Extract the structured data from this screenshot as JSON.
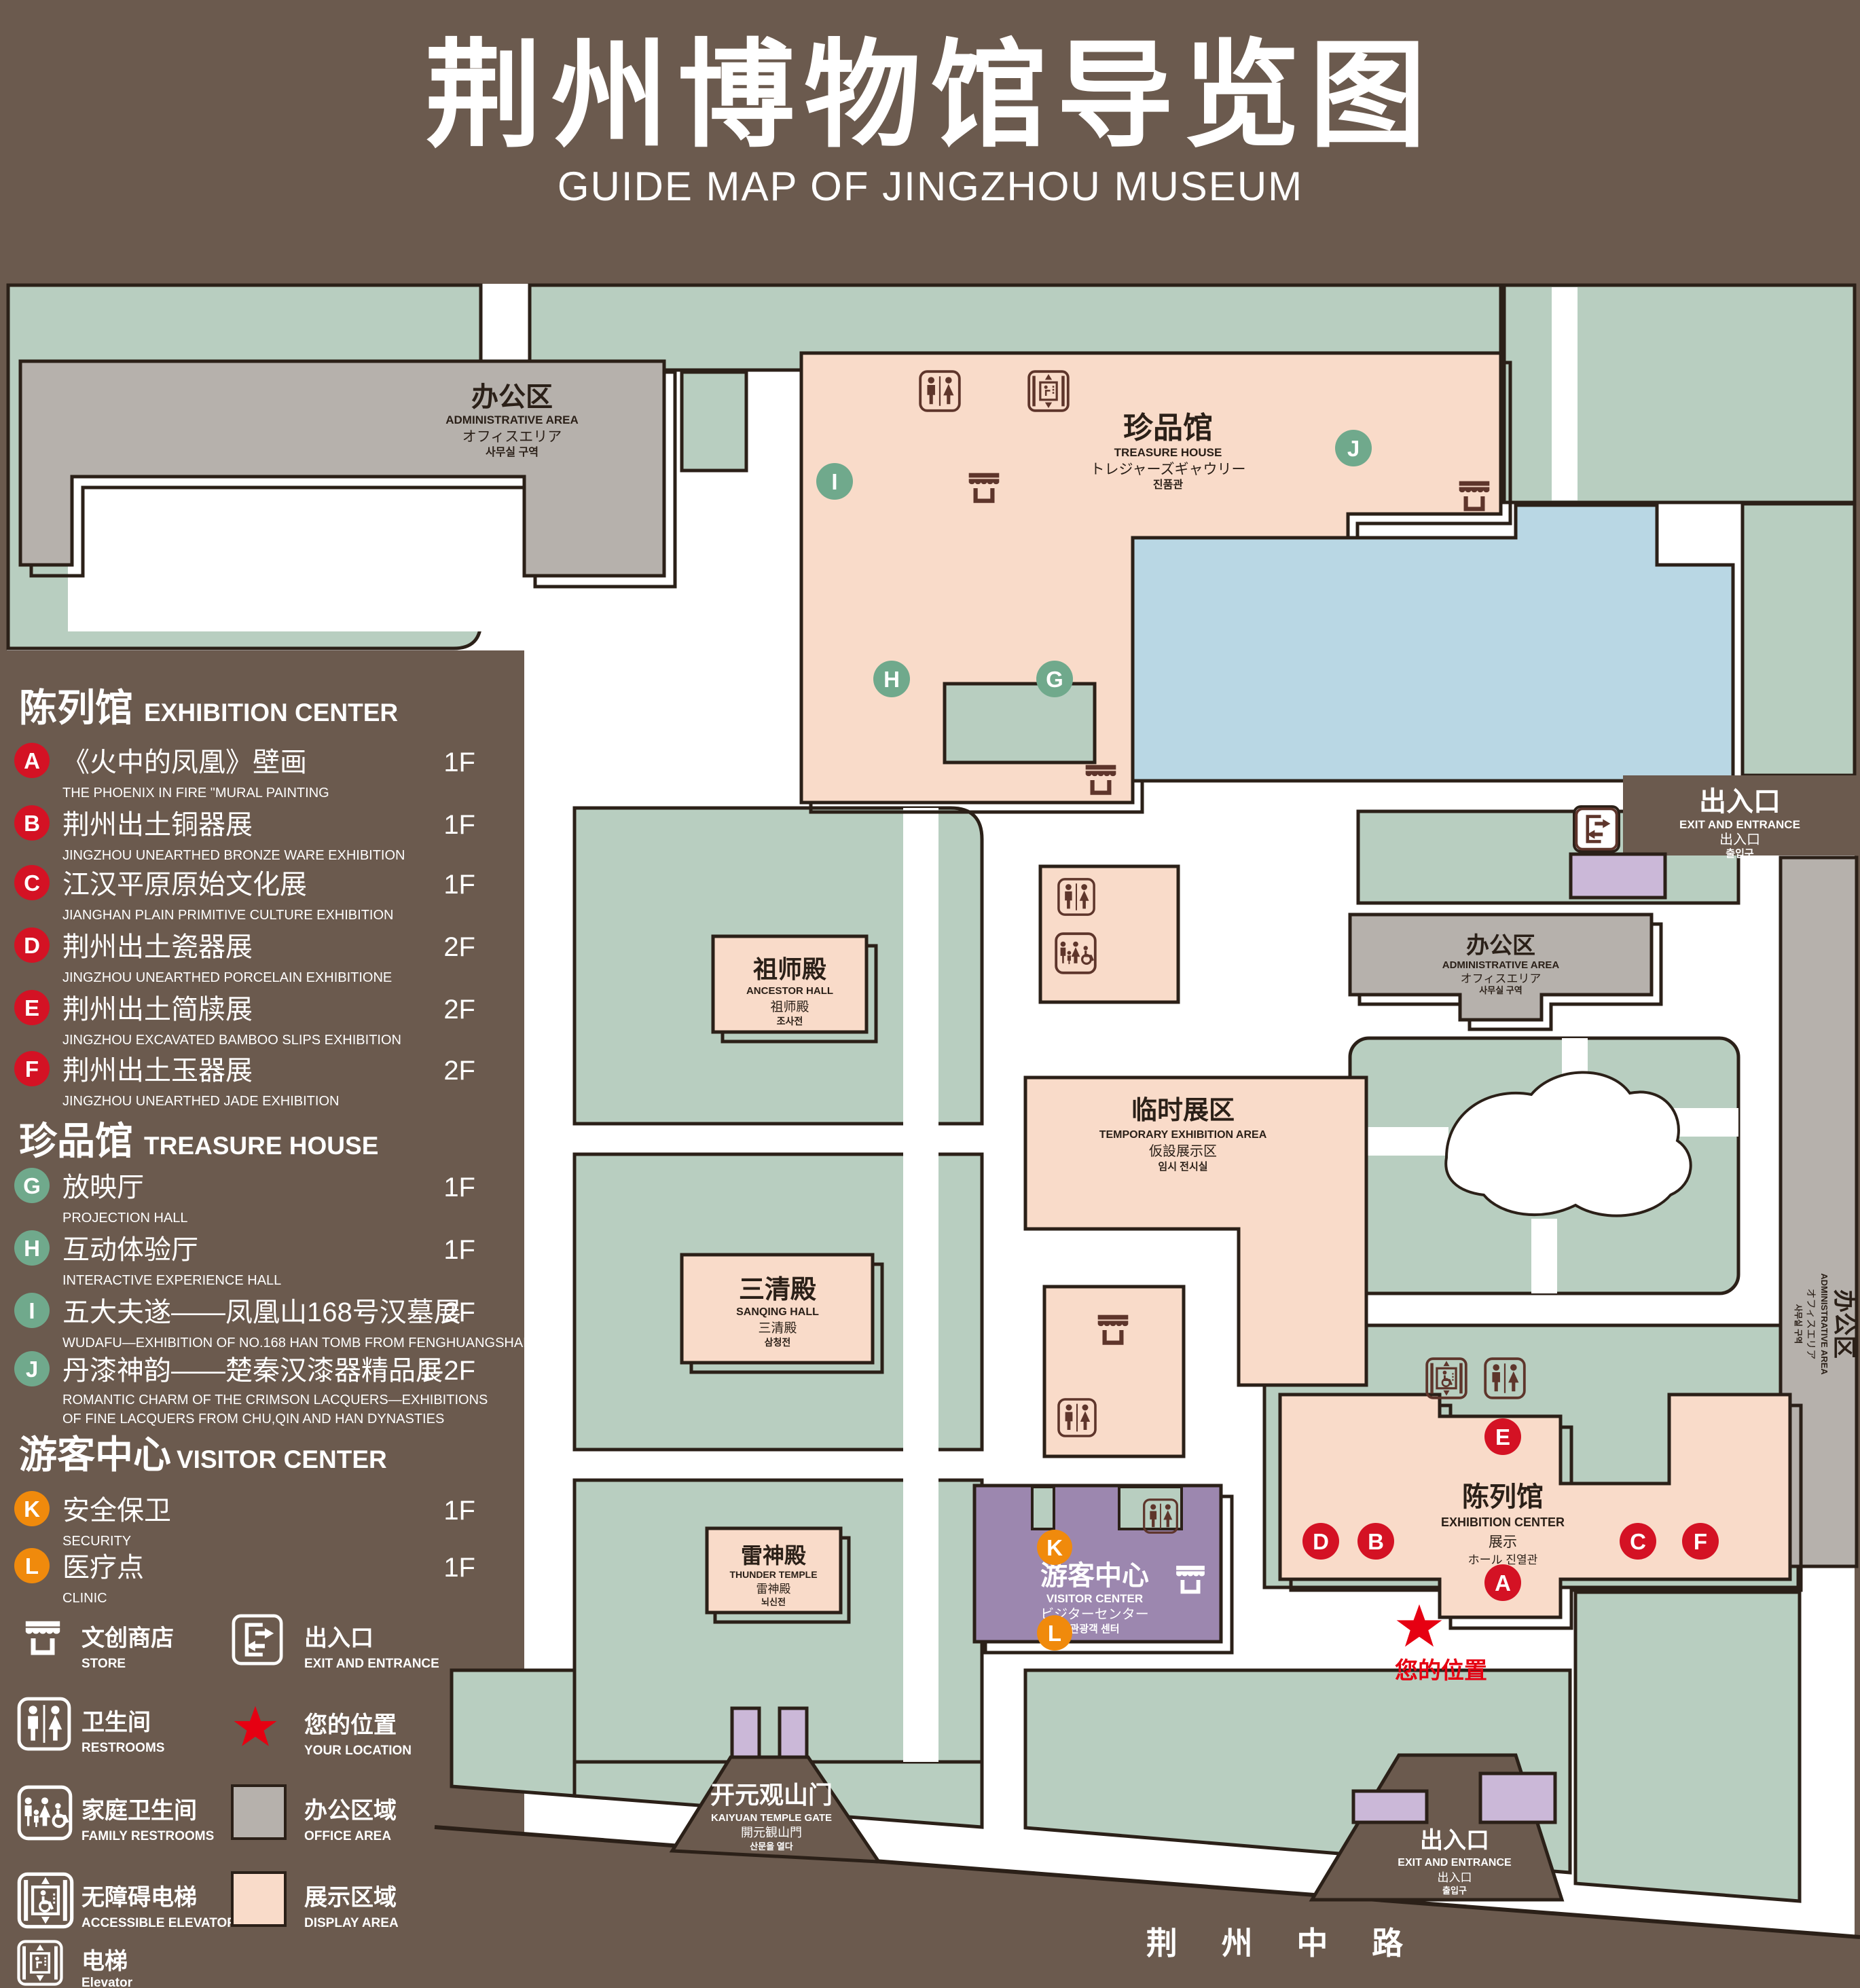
{
  "title": {
    "zh": "荆州博物馆导览图",
    "en": "GUIDE MAP OF JINGZHOU MUSEUM"
  },
  "legend": {
    "sections": [
      {
        "zh": "陈列馆",
        "en": "EXHIBITION CENTER",
        "items": [
          {
            "letter": "A",
            "zh": "《火中的凤凰》壁画",
            "en": "THE PHOENIX IN FIRE \"MURAL PAINTING",
            "floor": "1F"
          },
          {
            "letter": "B",
            "zh": "荆州出土铜器展",
            "en": "JINGZHOU UNEARTHED BRONZE WARE EXHIBITION",
            "floor": "1F"
          },
          {
            "letter": "C",
            "zh": "江汉平原原始文化展",
            "en": "JIANGHAN PLAIN PRIMITIVE CULTURE EXHIBITION",
            "floor": "1F"
          },
          {
            "letter": "D",
            "zh": "荆州出土瓷器展",
            "en": "JINGZHOU UNEARTHED PORCELAIN EXHIBITIONE",
            "floor": "2F"
          },
          {
            "letter": "E",
            "zh": "荆州出土简牍展",
            "en": "JINGZHOU EXCAVATED BAMBOO SLIPS EXHIBITION",
            "floor": "2F"
          },
          {
            "letter": "F",
            "zh": "荆州出土玉器展",
            "en": "JINGZHOU UNEARTHED JADE EXHIBITION",
            "floor": "2F"
          }
        ]
      },
      {
        "zh": "珍品馆",
        "en": "TREASURE HOUSE",
        "items": [
          {
            "letter": "G",
            "zh": "放映厅",
            "en": "PROJECTION HALL",
            "floor": "1F"
          },
          {
            "letter": "H",
            "zh": "互动体验厅",
            "en": "INTERACTIVE EXPERIENCE HALL",
            "floor": "1F"
          },
          {
            "letter": "I",
            "zh": "五大夫遂——凤凰山168号汉墓展",
            "en": "WUDAFU—EXHIBITION OF NO.168 HAN TOMB FROM FENGHUANGSHAN",
            "floor": "2F"
          },
          {
            "letter": "J",
            "zh": "丹漆神韵——楚秦汉漆器精品展",
            "en": "ROMANTIC CHARM OF THE CRIMSON LACQUERS—EXHIBITIONS",
            "en2": "OF FINE LACQUERS FROM CHU,QIN AND HAN DYNASTIES",
            "floor": "1-2F"
          }
        ]
      },
      {
        "zh": "游客中心",
        "en": "VISITOR CENTER",
        "items": [
          {
            "letter": "K",
            "zh": "安全保卫",
            "en": "SECURITY",
            "floor": "1F"
          },
          {
            "letter": "L",
            "zh": "医疗点",
            "en": "CLINIC",
            "floor": "1F"
          }
        ]
      }
    ],
    "symbols": {
      "store": {
        "zh": "文创商店",
        "en": "STORE"
      },
      "restrooms": {
        "zh": "卫生间",
        "en": "RESTROOMS"
      },
      "family": {
        "zh": "家庭卫生间",
        "en": "FAMILY RESTROOMS"
      },
      "accessible": {
        "zh": "无障碍电梯",
        "en": "ACCESSIBLE  ELEVATOR"
      },
      "elevator": {
        "zh": "电梯",
        "en": "Elevator"
      },
      "exit": {
        "zh": "出入口",
        "en": "EXIT AND ENTRANCE"
      },
      "location": {
        "zh": "您的位置",
        "en": "YOUR LOCATION"
      },
      "office": {
        "zh": "办公区域",
        "en": "OFFICE AREA"
      },
      "display": {
        "zh": "展示区域",
        "en": "DISPLAY AREA"
      }
    }
  },
  "map": {
    "admin": {
      "zh": "办公区",
      "en": "ADMINISTRATIVE AREA",
      "jp": "オフィスエリア",
      "kr": "사무실 구역"
    },
    "treasure": {
      "zh": "珍品馆",
      "en": "TREASURE HOUSE",
      "jp": "トレジャーズギャウリー",
      "kr": "진품관"
    },
    "ancestor": {
      "zh": "祖师殿",
      "en": "ANCESTOR HALL",
      "jp": "祖师殿",
      "kr": "조사전"
    },
    "sanqing": {
      "zh": "三清殿",
      "en": "SANQING HALL",
      "jp": "三清殿",
      "kr": "삼청전"
    },
    "thunder": {
      "zh": "雷神殿",
      "en": "THUNDER TEMPLE",
      "jp": "雷神殿",
      "kr": "뇌신전"
    },
    "temporary": {
      "zh": "临时展区",
      "en": "TEMPORARY  EXHIBITION  AREA",
      "jp": "仮設展示区",
      "kr": "임시 전시실"
    },
    "visitor": {
      "zh": "游客中心",
      "en": "VISITOR CENTER",
      "jp": "ビジターセンター",
      "kr": "관광객 센터"
    },
    "exhibition": {
      "zh": "陈列馆",
      "en": "EXHIBITION CENTER",
      "jp": "展示",
      "jp2": "ホール  진열관"
    },
    "gate": {
      "zh": "开元观山门",
      "en": "KAIYUAN TEMPLE GATE",
      "jp": "開元観山門",
      "kr": "산문을 열다"
    },
    "exit": {
      "zh": "出入口",
      "en": "EXIT AND ENTRANCE",
      "jp": "出入口",
      "kr": "출입구"
    },
    "your_location": "您的位置",
    "road": "荆 州 中 路",
    "markers": {
      "a": "A",
      "b": "B",
      "c": "C",
      "d": "D",
      "e": "E",
      "f": "F",
      "g": "G",
      "h": "H",
      "i": "I",
      "j": "J",
      "k": "K",
      "l": "L"
    }
  },
  "colors": {
    "background": "#6b5a4e",
    "outline": "#2b2018",
    "green": "#b8cec0",
    "pink": "#f9dbc9",
    "gray": "#b6b1ac",
    "lake": "#b9d7e4",
    "purple": "#9c87af",
    "light_purple": "#cbb8d8",
    "marker_red": "#d41224",
    "marker_green": "#70a98c",
    "marker_orange": "#f08a0c",
    "icon_maroon": "#5e352b",
    "location_red": "#e60012"
  }
}
